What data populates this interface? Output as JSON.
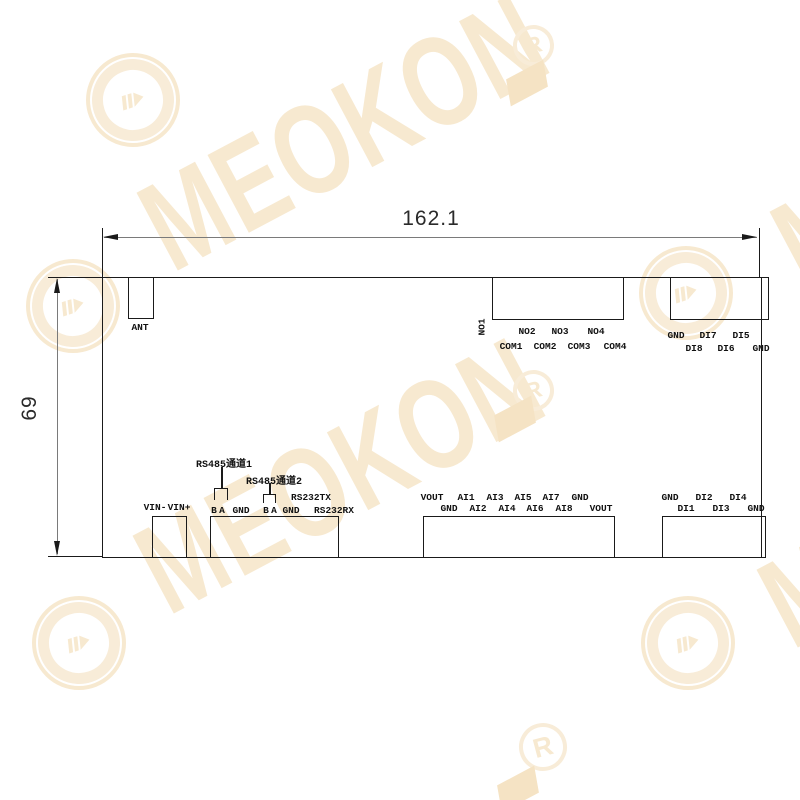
{
  "watermark": {
    "brand": "MEOKON",
    "registered": "R",
    "logo": "meokon-circle-logo",
    "color": "#f7e9d0"
  },
  "dimensions": {
    "width": "162.1",
    "height": "69"
  },
  "top": {
    "ant": {
      "label": "ANT"
    },
    "relay": {
      "side_label": "NO1",
      "row1": [
        "NO2",
        "NO3",
        "NO4"
      ],
      "row2": [
        "COM1",
        "COM2",
        "COM3",
        "COM4"
      ]
    },
    "digital": {
      "row1": [
        "GND",
        "DI7",
        "DI5"
      ],
      "row2": [
        "DI8",
        "DI6",
        "GND"
      ]
    }
  },
  "bottom": {
    "power": {
      "labels": [
        "VIN-",
        "VIN+"
      ]
    },
    "serial": {
      "rs485_channel1": "RS485通道1",
      "rs485_channel2": "RS485通道2",
      "rs232_tx": "RS232TX",
      "pins": [
        "B",
        "A",
        "GND",
        "B",
        "A",
        "GND",
        "RS232RX"
      ]
    },
    "analog": {
      "row1": [
        "VOUT",
        "AI1",
        "AI3",
        "AI5",
        "AI7",
        "GND"
      ],
      "row2": [
        "GND",
        "AI2",
        "AI4",
        "AI6",
        "AI8",
        "VOUT"
      ]
    },
    "digital": {
      "row1": [
        "GND",
        "DI2",
        "DI4"
      ],
      "row2": [
        "DI1",
        "DI3",
        "GND"
      ]
    }
  },
  "colors": {
    "outline": "#1a1a1a",
    "dimension_line": "#7a7a7a",
    "label_text": "#111111",
    "watermark": "#f7e9d0"
  }
}
